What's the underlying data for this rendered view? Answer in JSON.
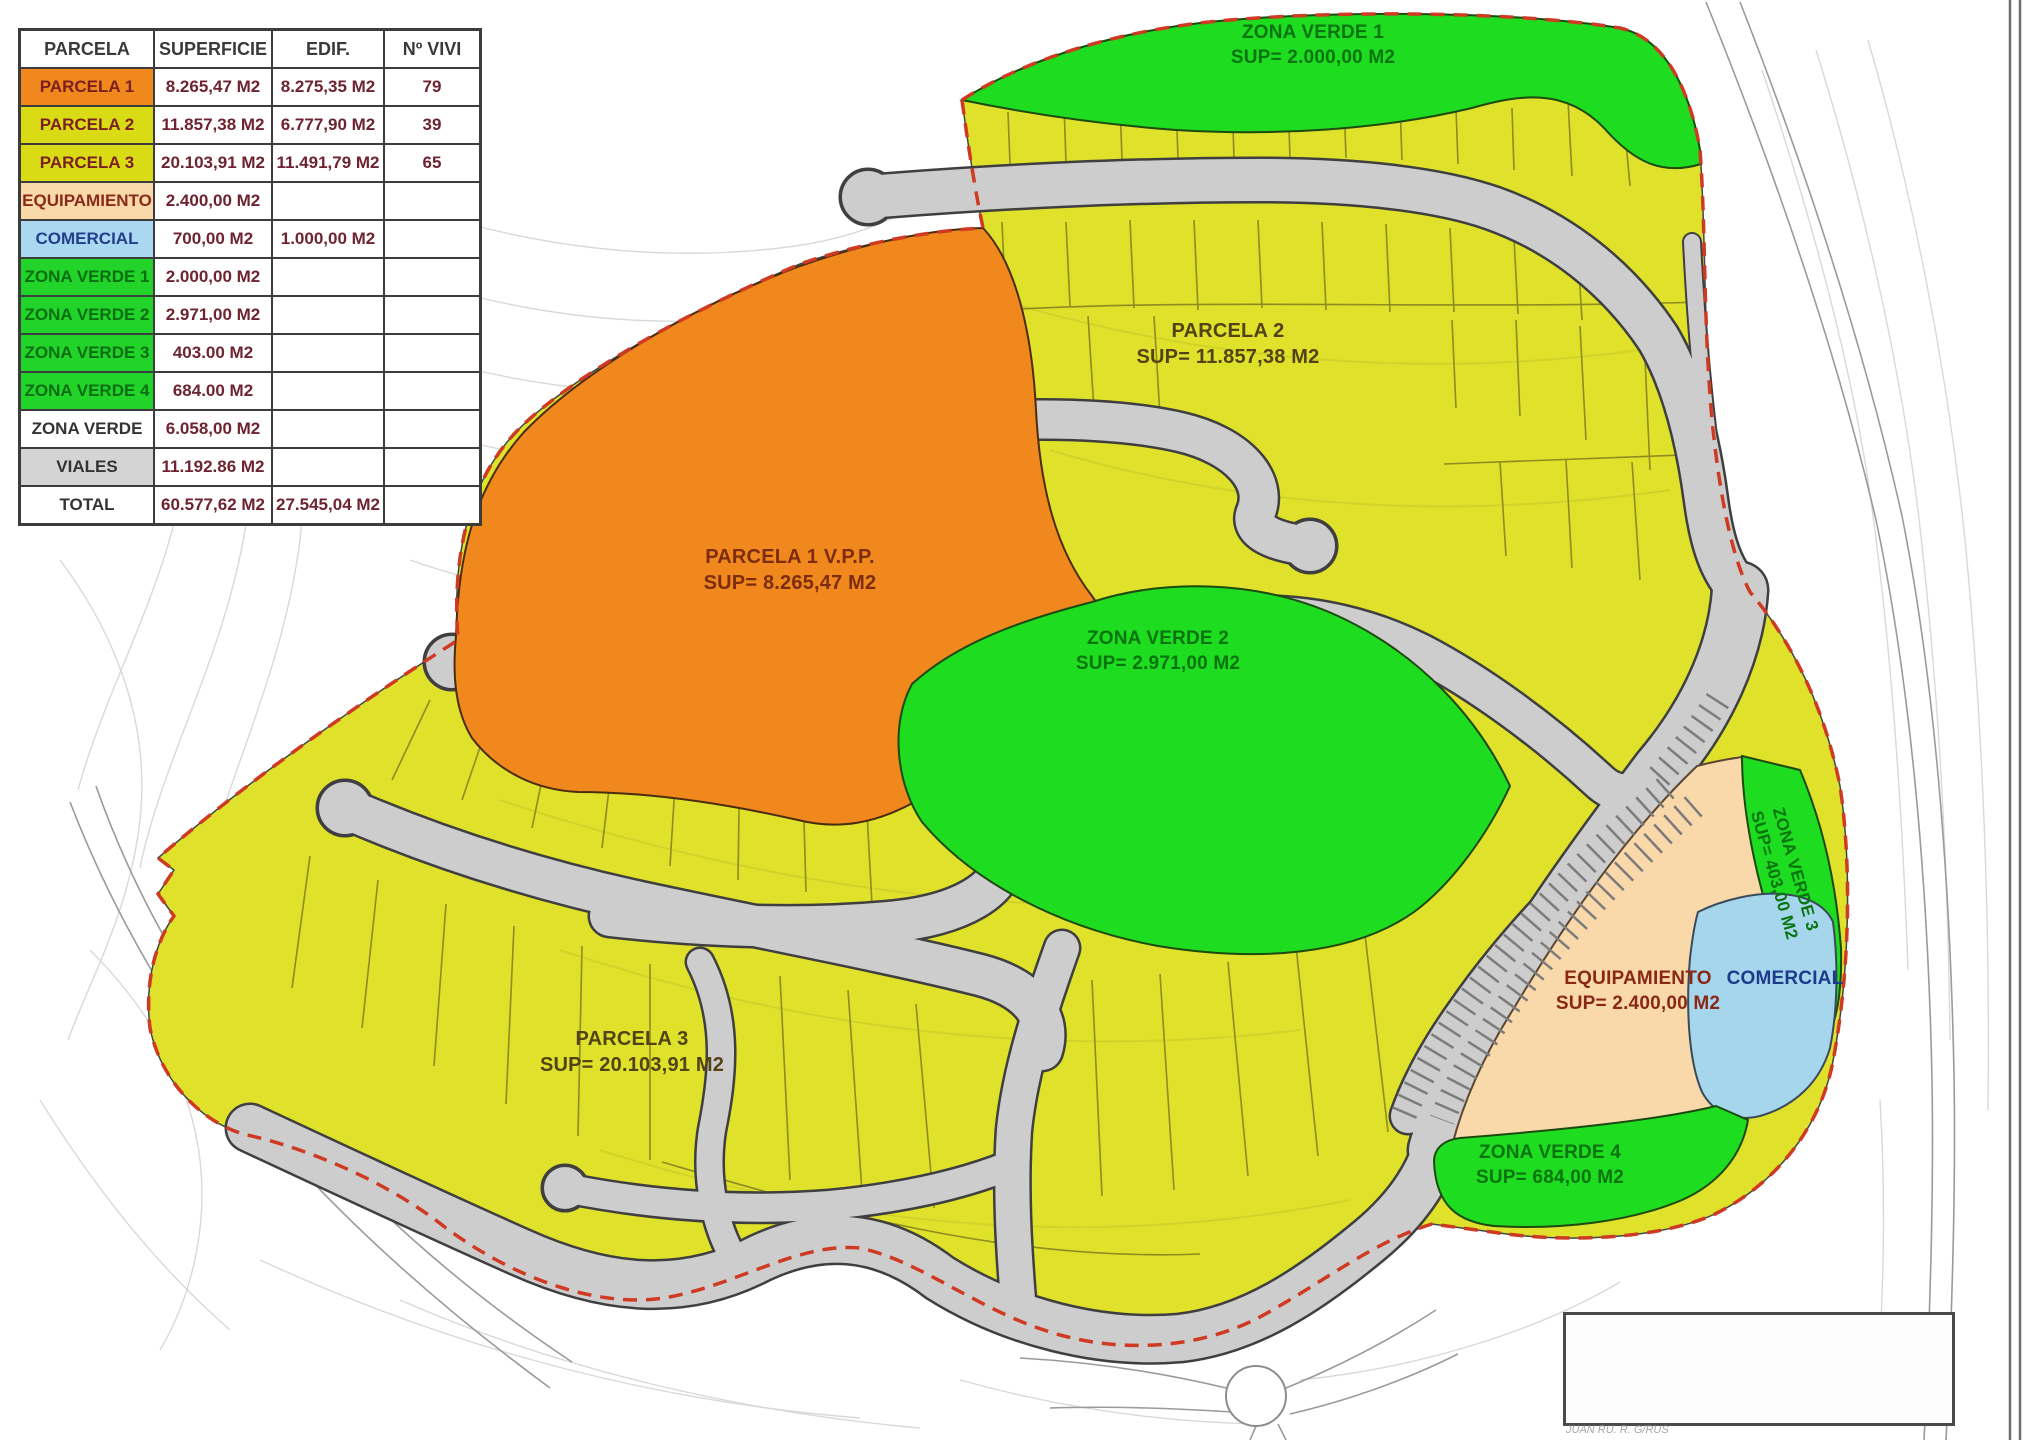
{
  "table": {
    "headers": [
      "PARCELA",
      "SUPERFICIE",
      "EDIF.",
      "Nº VIVI"
    ],
    "rows": [
      {
        "label": "PARCELA 1",
        "superficie": "8.265,47 M2",
        "edif": "8.275,35 M2",
        "vivi": "79"
      },
      {
        "label": "PARCELA 2",
        "superficie": "11.857,38 M2",
        "edif": "6.777,90 M2",
        "vivi": "39"
      },
      {
        "label": "PARCELA 3",
        "superficie": "20.103,91 M2",
        "edif": "11.491,79 M2",
        "vivi": "65"
      },
      {
        "label": "EQUIPAMIENTO",
        "superficie": "2.400,00 M2",
        "edif": "",
        "vivi": ""
      },
      {
        "label": "COMERCIAL",
        "superficie": "700,00 M2",
        "edif": "1.000,00 M2",
        "vivi": ""
      },
      {
        "label": "ZONA VERDE 1",
        "superficie": "2.000,00 M2",
        "edif": "",
        "vivi": ""
      },
      {
        "label": "ZONA VERDE 2",
        "superficie": "2.971,00 M2",
        "edif": "",
        "vivi": ""
      },
      {
        "label": "ZONA VERDE 3",
        "superficie": "403.00 M2",
        "edif": "",
        "vivi": ""
      },
      {
        "label": "ZONA VERDE 4",
        "superficie": "684.00 M2",
        "edif": "",
        "vivi": ""
      },
      {
        "label": "ZONA VERDE",
        "superficie": "6.058,00 M2",
        "edif": "",
        "vivi": ""
      },
      {
        "label": "VIALES",
        "superficie": "11.192.86 M2",
        "edif": "",
        "vivi": ""
      },
      {
        "label": "TOTAL",
        "superficie": "60.577,62 M2",
        "edif": "27.545,04 M2",
        "vivi": ""
      }
    ]
  },
  "map": {
    "regions": {
      "zona_verde_1": {
        "name": "ZONA VERDE 1",
        "sup": "SUP=  2.000,00 M2"
      },
      "parcela_2": {
        "name": "PARCELA 2",
        "sup": "SUP=  11.857,38 M2"
      },
      "parcela_1": {
        "name": "PARCELA 1 V.P.P.",
        "sup": "SUP=  8.265,47 M2"
      },
      "zona_verde_2": {
        "name": "ZONA VERDE 2",
        "sup": "SUP=  2.971,00 M2"
      },
      "parcela_3": {
        "name": "PARCELA 3",
        "sup": "SUP=  20.103,91 M2"
      },
      "equipamiento": {
        "name": "EQUIPAMIENTO",
        "sup": "SUP=  2.400,00 M2"
      },
      "comercial": {
        "name": "COMERCIAL"
      },
      "zona_verde_3": {
        "name": "ZONA VERDE 3",
        "sup": "SUP=  403,00 M2"
      },
      "zona_verde_4": {
        "name": "ZONA VERDE 4",
        "sup": "SUP=  684,00 M2"
      }
    },
    "colors": {
      "parcela_yellow": "#dfe12b",
      "parcela_1_orange": "#f0881e",
      "zona_verde_green": "#1edc1f",
      "equipamiento_peach": "#f9d8a9",
      "comercial_blue": "#a6d6ec",
      "viales_gray": "#cdcdcd",
      "boundary_red": "#cf3a23"
    }
  },
  "title_block": {
    "signature": "JUAN RU. R. G/RUS"
  }
}
